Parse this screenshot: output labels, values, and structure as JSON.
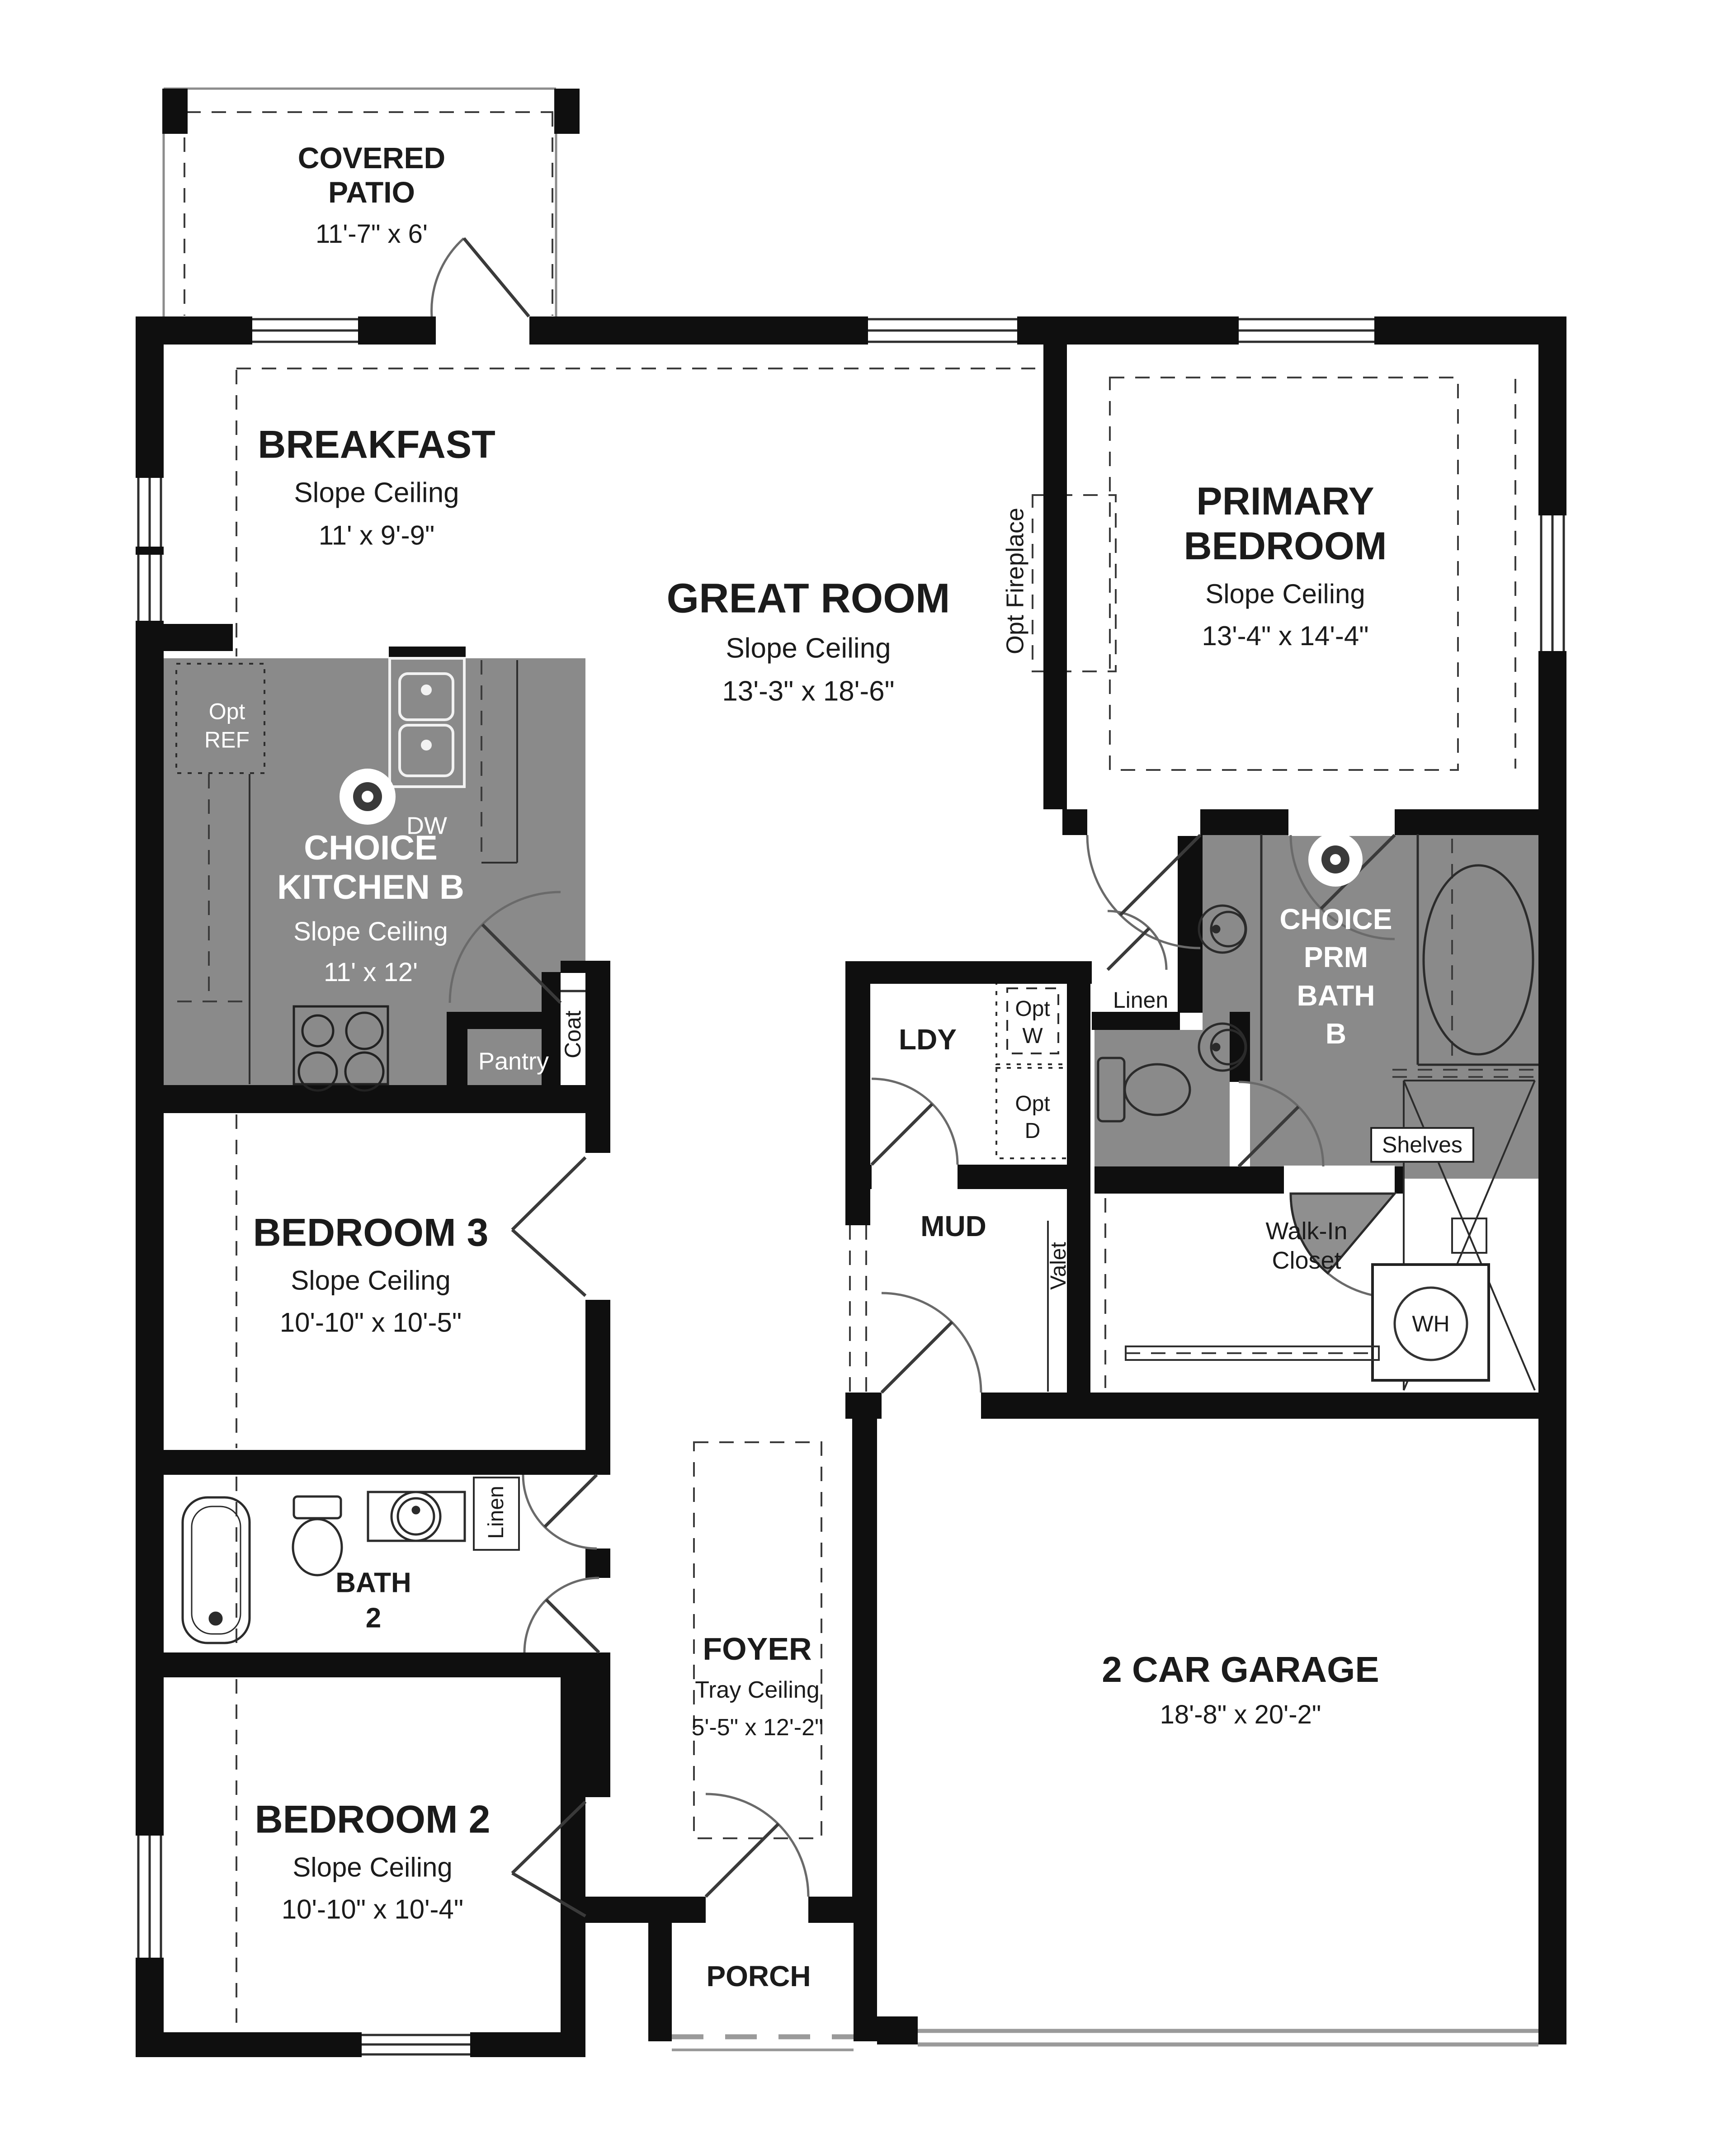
{
  "rooms": {
    "covered_patio": {
      "name": "COVERED\nPATIO",
      "dims": "11'-7\" x 6'"
    },
    "breakfast": {
      "name": "BREAKFAST",
      "ceiling": "Slope Ceiling",
      "dims": "11' x 9'-9\""
    },
    "great_room": {
      "name": "GREAT ROOM",
      "ceiling": "Slope Ceiling",
      "dims": "13'-3\" x 18'-6\""
    },
    "primary_bedroom": {
      "name": "PRIMARY\nBEDROOM",
      "ceiling": "Slope Ceiling",
      "dims": "13'-4\" x 14'-4\""
    },
    "kitchen": {
      "name": "CHOICE\nKITCHEN B",
      "ceiling": "Slope Ceiling",
      "dims": "11' x 12'"
    },
    "primary_bath": {
      "name": "CHOICE\nPRM\nBATH\nB"
    },
    "laundry": {
      "name": "LDY"
    },
    "mud": {
      "name": "MUD"
    },
    "walk_in_closet": {
      "name": "Walk-In\nCloset"
    },
    "bedroom3": {
      "name": "BEDROOM 3",
      "ceiling": "Slope Ceiling",
      "dims": "10'-10\" x 10'-5\""
    },
    "bath2": {
      "name": "BATH\n2"
    },
    "bedroom2": {
      "name": "BEDROOM 2",
      "ceiling": "Slope Ceiling",
      "dims": "10'-10\" x 10'-4\""
    },
    "foyer": {
      "name": "FOYER",
      "ceiling": "Tray Ceiling",
      "dims": "5'-5\" x 12'-2\""
    },
    "garage": {
      "name": "2 CAR GARAGE",
      "dims": "18'-8\" x 20'-2\""
    },
    "porch": {
      "name": "PORCH"
    }
  },
  "labels": {
    "opt_ref": "Opt\nREF",
    "dw": "DW",
    "pantry": "Pantry",
    "coat": "Coat",
    "linen_hall": "Linen",
    "linen_bath": "Linen",
    "valet": "Valet",
    "opt_w": "Opt\nW",
    "opt_d": "Opt\nD",
    "opt_fireplace": "Opt Fireplace",
    "shelves": "Shelves",
    "wh": "WH"
  },
  "colors": {
    "room_highlight": "#8a8a8a",
    "wall": "#0f0f0f"
  }
}
